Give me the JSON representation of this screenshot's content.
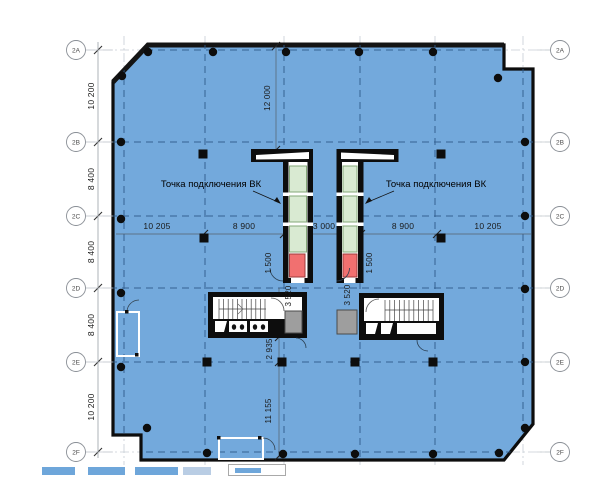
{
  "drawing": {
    "grid_rows": [
      "2A",
      "2B",
      "2C",
      "2D",
      "2E",
      "2F"
    ],
    "left_dims": [
      "10 200",
      "8 400",
      "8 400",
      "8 400",
      "10 200"
    ],
    "span_dims": [
      "10 205",
      "8 900",
      "3 000",
      "8 900",
      "10 205"
    ],
    "vertical_dims": {
      "top": "12 000",
      "shaft_left": "1 500",
      "shaft_right": "1 500",
      "core_left": "3 520",
      "core_right": "3 520",
      "mid": "2 935",
      "bottom": "11 155"
    },
    "annotations": {
      "left": "Точка подключения ВК",
      "right": "Точка подключения ВК"
    },
    "colors": {
      "floor": "#73a9dc",
      "elevator_green": "#d9ead2",
      "elevator_red": "#f17070",
      "service_gray": "#9e9e9e"
    }
  }
}
